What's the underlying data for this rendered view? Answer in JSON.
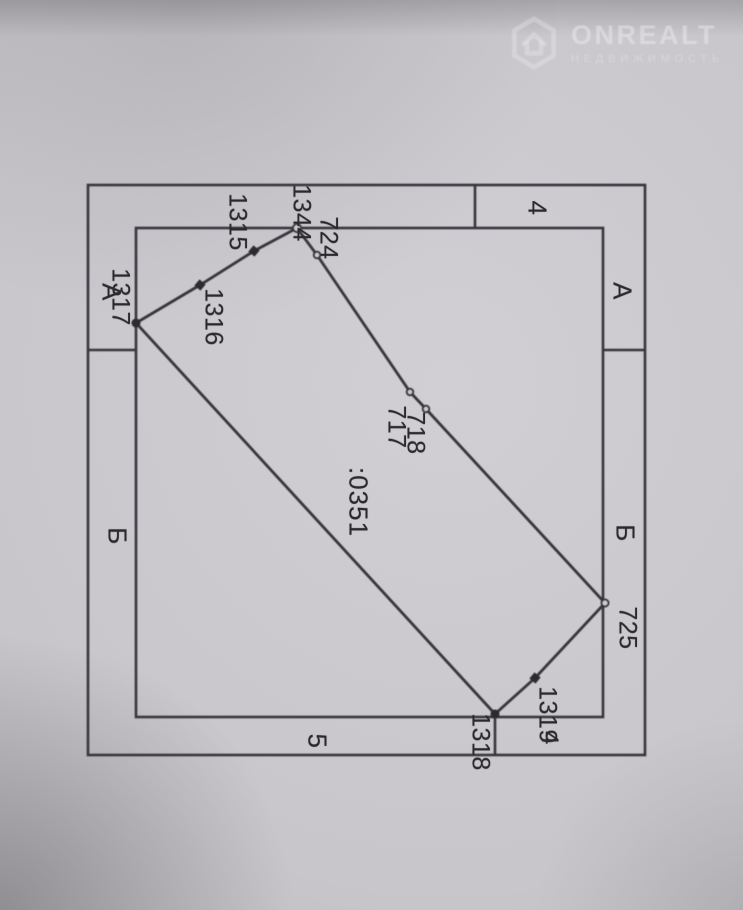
{
  "watermark": {
    "brand": "ONREALT",
    "tagline": "НЕДВИЖИМОСТЬ"
  },
  "plan": {
    "parcel_number": ":0351",
    "points": {
      "p1344": "1344",
      "p1315": "1315",
      "p1316": "1316",
      "p1317": "1317",
      "p724": "724",
      "p717": "717",
      "p718": "718",
      "p725": "725",
      "p1319": "1319",
      "p1318": "1318"
    },
    "overlap_mark": "4",
    "sections": {
      "top_right": "4",
      "bottom": "5",
      "left_top": "А",
      "left_bottom": "Б",
      "right_top": "А",
      "right_bottom": "Б"
    },
    "colors": {
      "line": "#38353a",
      "paper": "#c8c6ca",
      "watermark": "#f2f1f5"
    }
  }
}
